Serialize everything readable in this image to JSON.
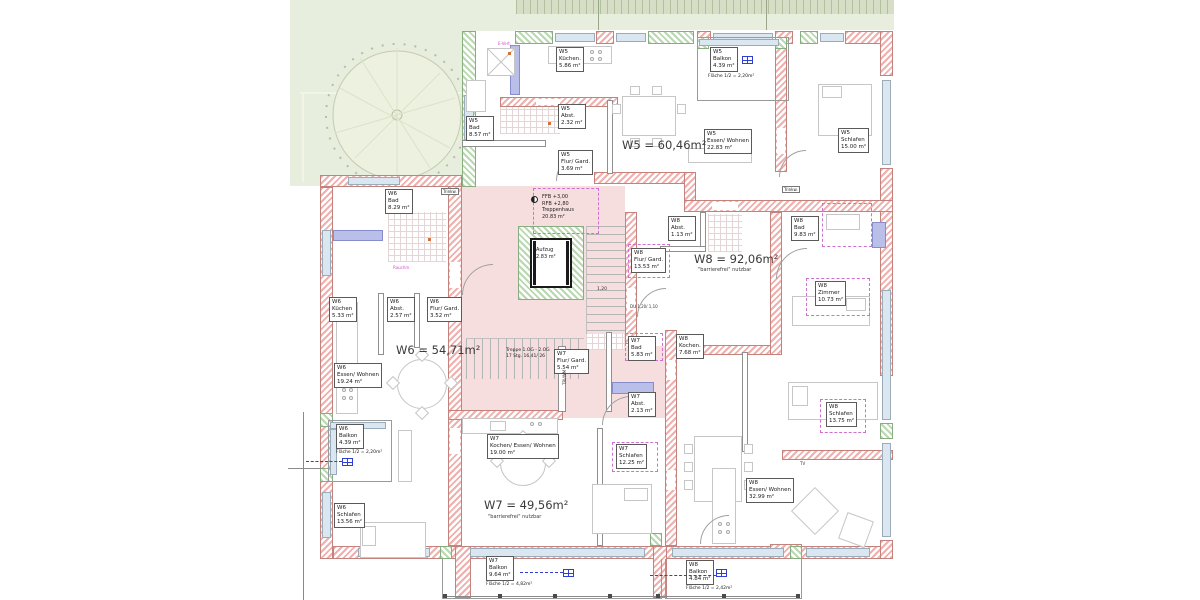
{
  "plan_meta": {
    "type": "floor-plan",
    "language": "de"
  },
  "colors": {
    "wall_red": "#efb0ad",
    "wall_green": "#b9d8b0",
    "stair_pink": "#f7dede",
    "garden_green": "#e8eedd",
    "window_blue": "#dbe7f0",
    "plumbing_blue": "#b9bfe8",
    "dash_magenta": "#cf6fcf",
    "leader_blue": "#2f3fd6"
  },
  "apartments": {
    "w5": {
      "total": "W5 = 60,46m²",
      "rooms": {
        "bad": {
          "unit": "W5",
          "name": "Bad",
          "area": "8.57 m²"
        },
        "kueche": {
          "unit": "W5",
          "name": "Küchen.",
          "area": "5.86 m²"
        },
        "abst": {
          "unit": "W5",
          "name": "Abst.",
          "area": "2.32 m²"
        },
        "flur": {
          "unit": "W5",
          "name": "Flur/ Gard.",
          "area": "3.69 m²"
        },
        "essen": {
          "unit": "W5",
          "name": "Essen/ Wohnen",
          "area": "22.83 m²"
        },
        "schlafen": {
          "unit": "W5",
          "name": "Schlafen",
          "area": "15.00 m²"
        },
        "balkon": {
          "unit": "W5",
          "name": "Balkon",
          "area": "4.39 m²",
          "half": "Fläche 1/2 = 2,20m²"
        }
      }
    },
    "w6": {
      "total": "W6 = 54,71m²",
      "rooms": {
        "bad": {
          "unit": "W6",
          "name": "Bad",
          "area": "8.29 m²"
        },
        "kueche": {
          "unit": "W6",
          "name": "Küchen",
          "area": "5.33 m²"
        },
        "abst": {
          "unit": "W6",
          "name": "Abst.",
          "area": "2.57 m²"
        },
        "flur": {
          "unit": "W6",
          "name": "Flur/ Gard.",
          "area": "3.52 m²"
        },
        "essen": {
          "unit": "W6",
          "name": "Essen/ Wohnen",
          "area": "19.24 m²"
        },
        "balkon": {
          "unit": "W6",
          "name": "Balkon",
          "area": "4.39 m²",
          "half": "Fläche 1/2 = 2,20m²"
        },
        "schlafen": {
          "unit": "W6",
          "name": "Schlafen",
          "area": "13.56 m²"
        }
      }
    },
    "w7": {
      "total": "W7 = 49,56m²",
      "note": "\"barrierefrei\" nutzbar",
      "rooms": {
        "flur": {
          "unit": "W7",
          "name": "Flur/ Gard.",
          "area": "5.54 m²"
        },
        "bad": {
          "unit": "W7",
          "name": "Bad",
          "area": "5.83 m²"
        },
        "abst": {
          "unit": "W7",
          "name": "Abst.",
          "area": "2.13 m²"
        },
        "kochen": {
          "unit": "W7",
          "name": "Kochen/ Essen/ Wohnen",
          "area": "19.00 m²"
        },
        "schlafen": {
          "unit": "W7",
          "name": "Schlafen",
          "area": "12.25 m²"
        },
        "balkon": {
          "unit": "W7",
          "name": "Balkon",
          "area": "9.64 m²",
          "half": "Fläche 1/2 = 4,82m²"
        }
      }
    },
    "w8": {
      "total": "W8 = 92,06m²",
      "note": "\"barrierefrei\" nutzbar",
      "rooms": {
        "abst": {
          "unit": "W8",
          "name": "Abst.",
          "area": "1.13 m²"
        },
        "bad": {
          "unit": "W8",
          "name": "Bad",
          "area": "9.83 m²"
        },
        "flur": {
          "unit": "W8",
          "name": "Flur/ Gard.",
          "area": "13.53 m²"
        },
        "kueche": {
          "unit": "W8",
          "name": "Kochen.",
          "area": "7.68 m²"
        },
        "zimmer": {
          "unit": "W8",
          "name": "Zimmer",
          "area": "10.73 m²"
        },
        "schlafen": {
          "unit": "W8",
          "name": "Schlafen",
          "area": "13.75 m²"
        },
        "essen": {
          "unit": "W8",
          "name": "Essen/ Wohnen",
          "area": "32.99 m²"
        },
        "balkon": {
          "unit": "W8",
          "name": "Balkon",
          "area": "4.84 m²",
          "half": "Fläche 1/2 = 2,42m²"
        }
      }
    }
  },
  "stairwell": {
    "ffb": "FFB +3,00",
    "rfb": "RFB +2,80",
    "name": "Treppenhaus",
    "area": "20.83 m²",
    "lift": "Aufzug",
    "lift_area": "2.83 m²",
    "stairs1": "Treppe 1.OG - 2.OG",
    "stairs2": "17 Stg. 16,41/ 26",
    "dim": "1,20",
    "shower": "DU 1,20/ 1,10"
  },
  "annotations": {
    "trinkw": "Trinkw.",
    "tri_wm": "TRI/WM",
    "tv": "TV",
    "e_vert": "E-Vert.",
    "rauchm": "Rauchm."
  }
}
